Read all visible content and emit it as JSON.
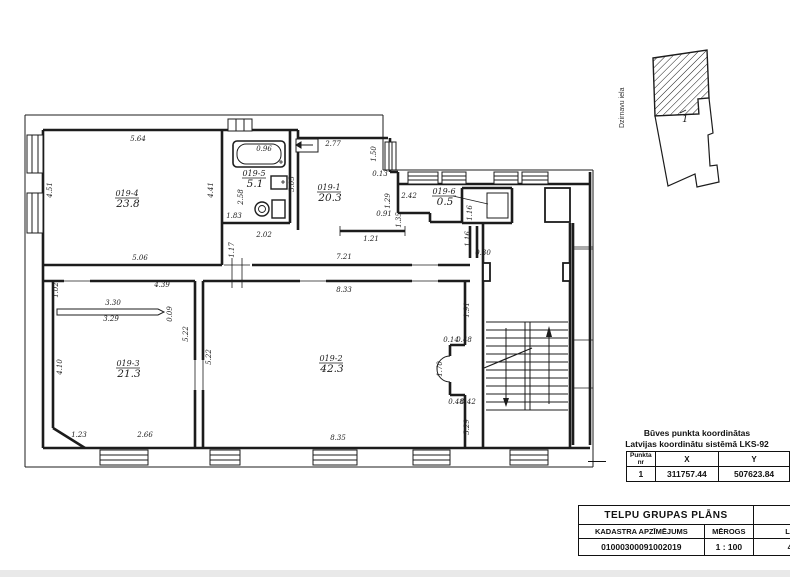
{
  "site_plan": {
    "street": "Dzirnavu iela",
    "point": "1"
  },
  "rooms": [
    {
      "id": "019-4",
      "area": "23.8",
      "x": 127,
      "y": 196
    },
    {
      "id": "019-5",
      "area": "5.1",
      "x": 254,
      "y": 176
    },
    {
      "id": "019-1",
      "area": "20.3",
      "x": 329,
      "y": 190
    },
    {
      "id": "019-6",
      "area": "0.5",
      "x": 444,
      "y": 194
    },
    {
      "id": "019-3",
      "area": "21.3",
      "x": 128,
      "y": 366
    },
    {
      "id": "019-2",
      "area": "42.3",
      "x": 331,
      "y": 361
    }
  ],
  "dims": [
    {
      "t": "5.64",
      "x": 138,
      "y": 141
    },
    {
      "t": "4.51",
      "x": 52,
      "y": 190,
      "r": -90
    },
    {
      "t": "4.41",
      "x": 213,
      "y": 190,
      "r": -90
    },
    {
      "t": "5.06",
      "x": 140,
      "y": 260
    },
    {
      "t": "0.96",
      "x": 264,
      "y": 151
    },
    {
      "t": "2.58",
      "x": 243,
      "y": 197,
      "r": -90
    },
    {
      "t": "1.83",
      "x": 234,
      "y": 218
    },
    {
      "t": "2.02",
      "x": 264,
      "y": 237
    },
    {
      "t": "3.05",
      "x": 294,
      "y": 184,
      "r": -90
    },
    {
      "t": "2.77",
      "x": 333,
      "y": 146
    },
    {
      "t": "1.50",
      "x": 376,
      "y": 154,
      "r": -90
    },
    {
      "t": "0.13",
      "x": 380,
      "y": 176
    },
    {
      "t": "1.29",
      "x": 390,
      "y": 201,
      "r": -90
    },
    {
      "t": "0.91",
      "x": 384,
      "y": 216
    },
    {
      "t": "1.35",
      "x": 401,
      "y": 220,
      "r": -90
    },
    {
      "t": "1.21",
      "x": 371,
      "y": 241
    },
    {
      "t": "7.21",
      "x": 344,
      "y": 259
    },
    {
      "t": "1.17",
      "x": 234,
      "y": 250,
      "r": -90
    },
    {
      "t": "2.42",
      "x": 409,
      "y": 198
    },
    {
      "t": "1.16",
      "x": 472,
      "y": 213,
      "r": -90
    },
    {
      "t": "1.16",
      "x": 470,
      "y": 239,
      "r": -90
    },
    {
      "t": "0.30",
      "x": 483,
      "y": 255
    },
    {
      "t": "4.39",
      "x": 162,
      "y": 287
    },
    {
      "t": "1.02",
      "x": 58,
      "y": 290,
      "r": -90
    },
    {
      "t": "3.30",
      "x": 113,
      "y": 305
    },
    {
      "t": "3.29",
      "x": 111,
      "y": 321
    },
    {
      "t": "0.09",
      "x": 172,
      "y": 314,
      "r": -90
    },
    {
      "t": "5.22",
      "x": 188,
      "y": 334,
      "r": -90
    },
    {
      "t": "5.22",
      "x": 211,
      "y": 357,
      "r": -90
    },
    {
      "t": "4.10",
      "x": 62,
      "y": 367,
      "r": -90
    },
    {
      "t": "1.23",
      "x": 79,
      "y": 437
    },
    {
      "t": "2.66",
      "x": 145,
      "y": 437
    },
    {
      "t": "8.33",
      "x": 344,
      "y": 292
    },
    {
      "t": "8.35",
      "x": 338,
      "y": 440
    },
    {
      "t": "1.91",
      "x": 469,
      "y": 310,
      "r": -90
    },
    {
      "t": "0.14",
      "x": 451,
      "y": 342
    },
    {
      "t": "0.48",
      "x": 464,
      "y": 342
    },
    {
      "t": "1.70",
      "x": 442,
      "y": 369,
      "r": -90
    },
    {
      "t": "0.48",
      "x": 456,
      "y": 404
    },
    {
      "t": "0.42",
      "x": 468,
      "y": 404
    },
    {
      "t": "5.29",
      "x": 469,
      "y": 427,
      "r": -90
    }
  ],
  "coord_block": {
    "title1": "Būves punkta koordinātas",
    "title2": "Latvijas koordinātu sistēmā LKS-92",
    "col_point_a": "Punkta",
    "col_point_b": "nr",
    "col_x": "X",
    "col_y": "Y",
    "row": {
      "nr": "1",
      "x": "311757.44",
      "y": "507623.84"
    }
  },
  "title_block": {
    "title": "TELPU GRUPAS PLĀNS",
    "col1": "KADASTRA APZĪMĒJUMS",
    "col2": "MĒROGS",
    "col3": "LP",
    "val1": "01000300091002019",
    "val2": "1 : 100",
    "val3": "4"
  },
  "colors": {
    "ink": "#1c1c1c",
    "paper": "#ffffff"
  }
}
